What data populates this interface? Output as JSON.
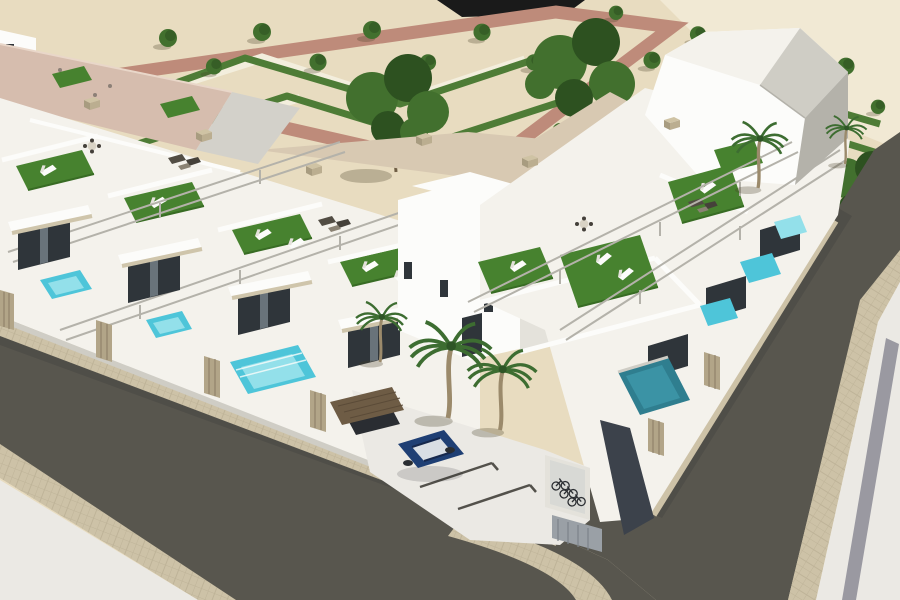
{
  "scene": {
    "type": "3d-architectural-aerial-render",
    "alt": "Aerial 3D architectural rendering of a modern white townhouse development on a street corner. Rows of flat-roofed units have rooftop terraces with artificial turf, sun loungers and pergola rails; small turquoise plunge pools and tan slatted fences line the front yards. A formal garden with chevron-shaped hedges, small trees and rose-colored paths spreads across sandy ground behind the complex. Dark asphalt streets with paved sidewalks wrap the corner; a navy car is parked in the forecourt beside a carport and a bicycle rack."
  },
  "objects": {
    "townhouse_rows": 2,
    "roof_terraces_with_turf": 9,
    "plunge_pools": 8,
    "parked_cars": 2,
    "carports": 1,
    "bike_racks": 1,
    "palm_trees": 5,
    "park_trees": 20,
    "streets": 2,
    "garden_style": "chevron hedge parterre"
  },
  "colors": {
    "sand": "#e8dcc0",
    "sandLight": "#f1e9d4",
    "pathRed": "#be8b7a",
    "walkWhite": "#f3eedd",
    "hedge": "#4e7c36",
    "treeGreen": "#42702e",
    "treeGreenDark": "#2d5120",
    "treeTrunk": "#6f5e45",
    "roofPink": "#d6bdae",
    "roofGray": "#d3d1ca",
    "white": "#fcfcfa",
    "whiteWarm": "#f4f2ec",
    "shade1": "#e4e2db",
    "shade2": "#cfcdc5",
    "shade3": "#b4b2aa",
    "glass": "#2f353a",
    "glassLight": "#69737a",
    "turf": "#47822f",
    "turfDark": "#386c24",
    "pool": "#4ec5d9",
    "poolLight": "#93e0ea",
    "poolDeep": "#2f7e8f",
    "road": "#58564e",
    "cobble": "#cdc2a7",
    "cobbleLine": "#b3a88c",
    "pavement": "#ebe9e4",
    "stripeGray": "#9a99a1",
    "fence": "#b2a588",
    "fenceDark": "#897c64",
    "balconyBeige": "#cfc5ab",
    "carNavy": "#1f3f74",
    "carRoof": "#d9dee4",
    "carDark": "#2a2d32",
    "carportRoof": "#6e5c45",
    "darkWall": "#3c424b",
    "ink": "#1a1a1a",
    "apron": "#d8c9b2",
    "furniture": "#524d44",
    "palmTrunk": "#9b8a6b",
    "palmFrond": "#3d6d31",
    "bike": "#2c2f33"
  }
}
